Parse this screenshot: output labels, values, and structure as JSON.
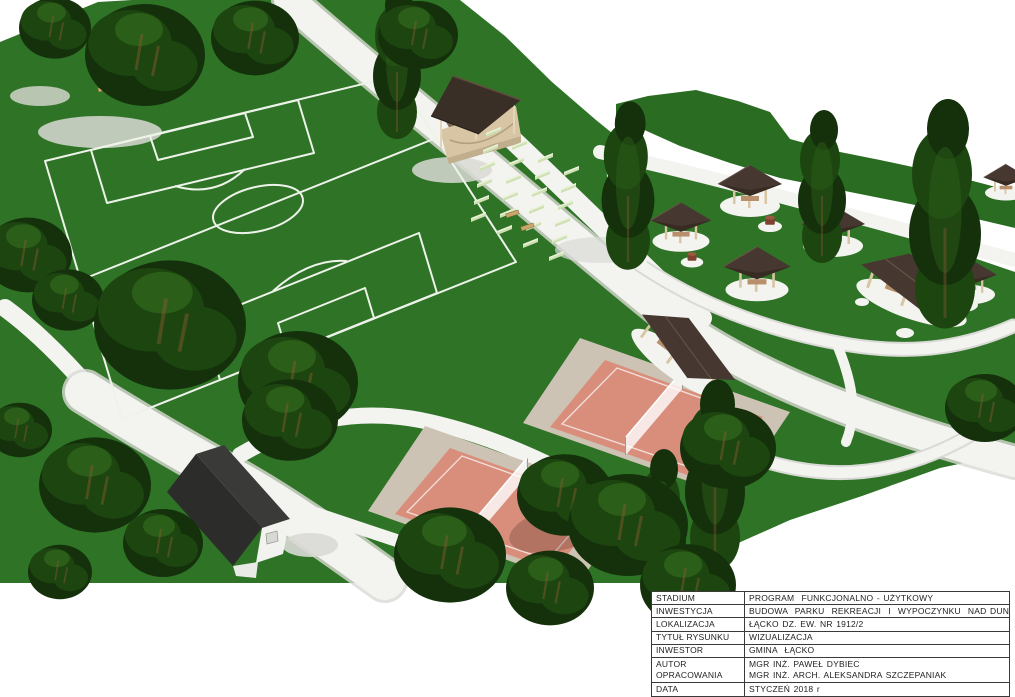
{
  "page": {
    "background": "#ffffff"
  },
  "visualization": {
    "type": "3d-park-render",
    "elements": [
      "soccer-field",
      "stage-pavilion",
      "audience-benches",
      "picnic-gazebos",
      "grill-pavilions",
      "volleyball-courts",
      "fire-pits",
      "park-paths",
      "house",
      "trees",
      "hills"
    ]
  },
  "palette": {
    "white": "#ffffff",
    "lawn": "#2e7326",
    "hill": "#2a6d22",
    "treeDark": "#14310c",
    "treeMid": "#1d4510",
    "treeLight": "#2b5e18",
    "trunk": "#8a5a33",
    "path": "#f3f3f0",
    "pathShade": "#d9d9d5",
    "fieldLine": "#eef3ea",
    "roofBrown": "#463830",
    "roofEdge": "#33281f",
    "houseRoofL": "#2c2c2a",
    "houseRoofR": "#3a3a38",
    "wallCream": "#d7c5a3",
    "wallWhite": "#f2f2ef",
    "deckEdge": "#c0ae8c",
    "bench": "#cfe0b2",
    "benchLight": "#ecf3dd",
    "court": "#d98e7c",
    "pad": "#cdc3b4",
    "pit": "#7d4330",
    "pitTop": "#9a5a40",
    "tableBorder": "#3a3a3a",
    "tableText": "#1f1f1f"
  },
  "title_block": {
    "rows": [
      {
        "label": "STADIUM",
        "value": "PROGRAM  FUNKCJONALNO - UŻYTKOWY"
      },
      {
        "label": "INWESTYCJA",
        "value": "BUDOWA  PARKU  REKREACJI  I  WYPOCZYNKU  NAD DUNAJCEM"
      },
      {
        "label": "LOKALIZACJA",
        "value": "ŁĄCKO DZ. EW. NR 1912/2"
      },
      {
        "label": "TYTUŁ RYSUNKU",
        "value": "WIZUALIZACJA"
      },
      {
        "label": "INWESTOR",
        "value": "GMINA  ŁĄCKO"
      },
      {
        "label_line1": "AUTOR",
        "label_line2": "OPRACOWANIA",
        "value_line1": "MGR INŻ. PAWEŁ DYBIEC",
        "value_line2": "MGR INŻ. ARCH. ALEKSANDRA SZCZEPANIAK"
      },
      {
        "label": "DATA",
        "value": "STYCZEŃ 2018 r"
      }
    ]
  }
}
